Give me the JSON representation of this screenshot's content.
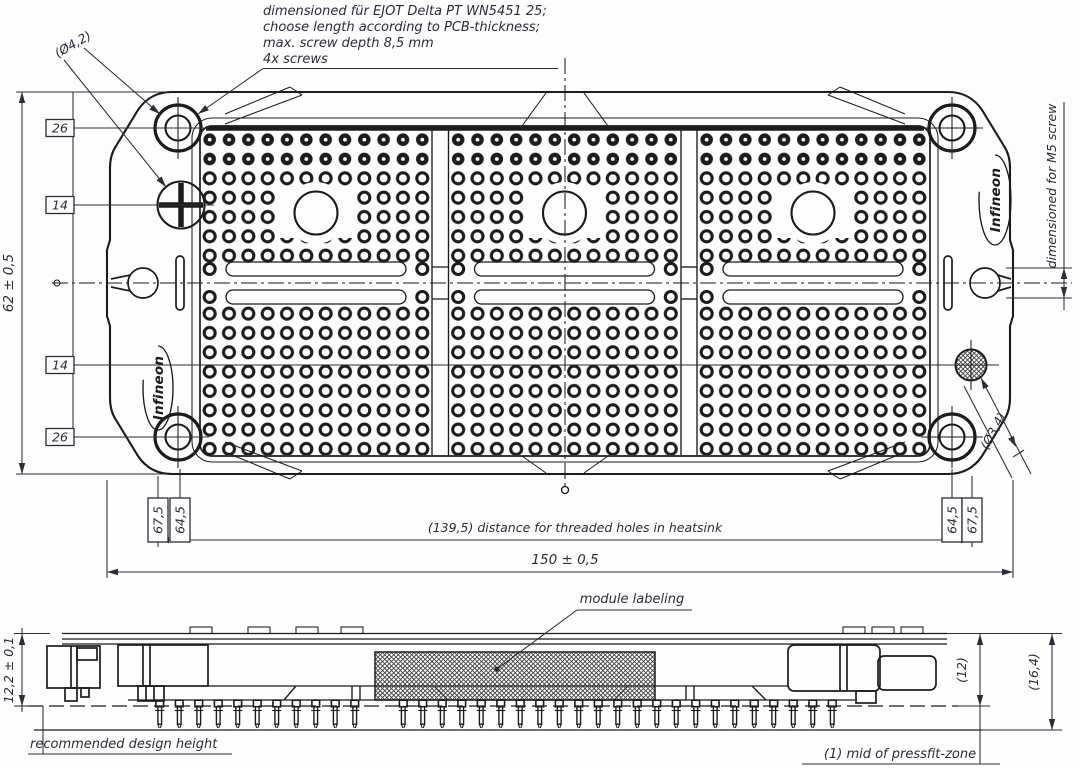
{
  "notes": {
    "screw_note": [
      "dimensioned für EJOT Delta PT WN5451 25;",
      "choose length according to PCB-thickness;",
      "max. screw depth 8,5 mm",
      "4x screws"
    ]
  },
  "top_view": {
    "overall_height": "62 ± 0,5",
    "overall_width": "150 ± 0,5",
    "threaded_holes_note": "(139,5) distance for threaded holes in heatsink",
    "offset_26": "26",
    "offset_14": "14",
    "screw_hole_dia": "(Ø4,2)",
    "pin_hole_dia": "(Ø3,4)",
    "offset_67_5": "67,5",
    "offset_64_5": "64,5",
    "m5_note": "dimensioned for M5 screw",
    "logo": "Infineon"
  },
  "side_view": {
    "module_labeling": "module labeling",
    "design_height_dim": "12,2 ± 0,1",
    "design_height_note": "recommended design height",
    "body_height": "(12)",
    "total_height": "(16,4)",
    "pressfit_ref": "(1) mid of pressfit-zone"
  },
  "colors": {
    "line": "#1c1c1e",
    "text": "#2e2b3a",
    "background": "#fdfdfd"
  }
}
